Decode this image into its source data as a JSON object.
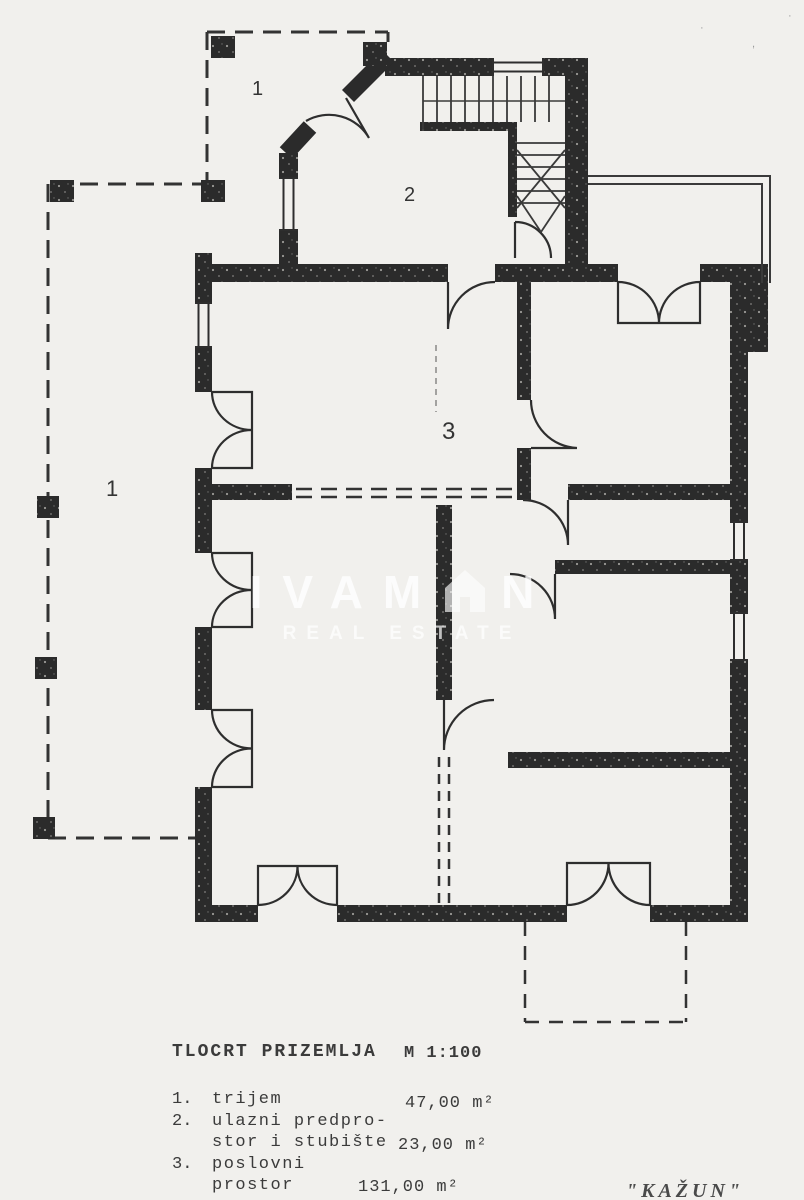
{
  "page": {
    "background": "#f1f0ed",
    "ink": "#2a2a2a"
  },
  "watermark": {
    "brand_prefix": "IVAM",
    "brand_suffix": "N",
    "tagline": "REAL ESTATE",
    "color": "#ffffff"
  },
  "plan_labels": {
    "porch_top": "1",
    "vestibule": "2",
    "porch_left": "1",
    "office": "3"
  },
  "legend": {
    "title": "TLOCRT PRIZEMLJA",
    "scale": "M 1:100",
    "items": [
      {
        "num": "1.",
        "line1": "trijem",
        "line2": "",
        "area": "47,00 m²"
      },
      {
        "num": "2.",
        "line1": "ulazni predpro-",
        "line2": "stor i stubište",
        "area": "23,00 m²"
      },
      {
        "num": "3.",
        "line1": "poslovni",
        "line2": "prostor",
        "area": "131,00 m²"
      }
    ]
  },
  "footer": {
    "property_name": "\"KAŽUN\""
  },
  "specks": {
    "s1": "·",
    "s2": ",",
    "s3": "·"
  }
}
